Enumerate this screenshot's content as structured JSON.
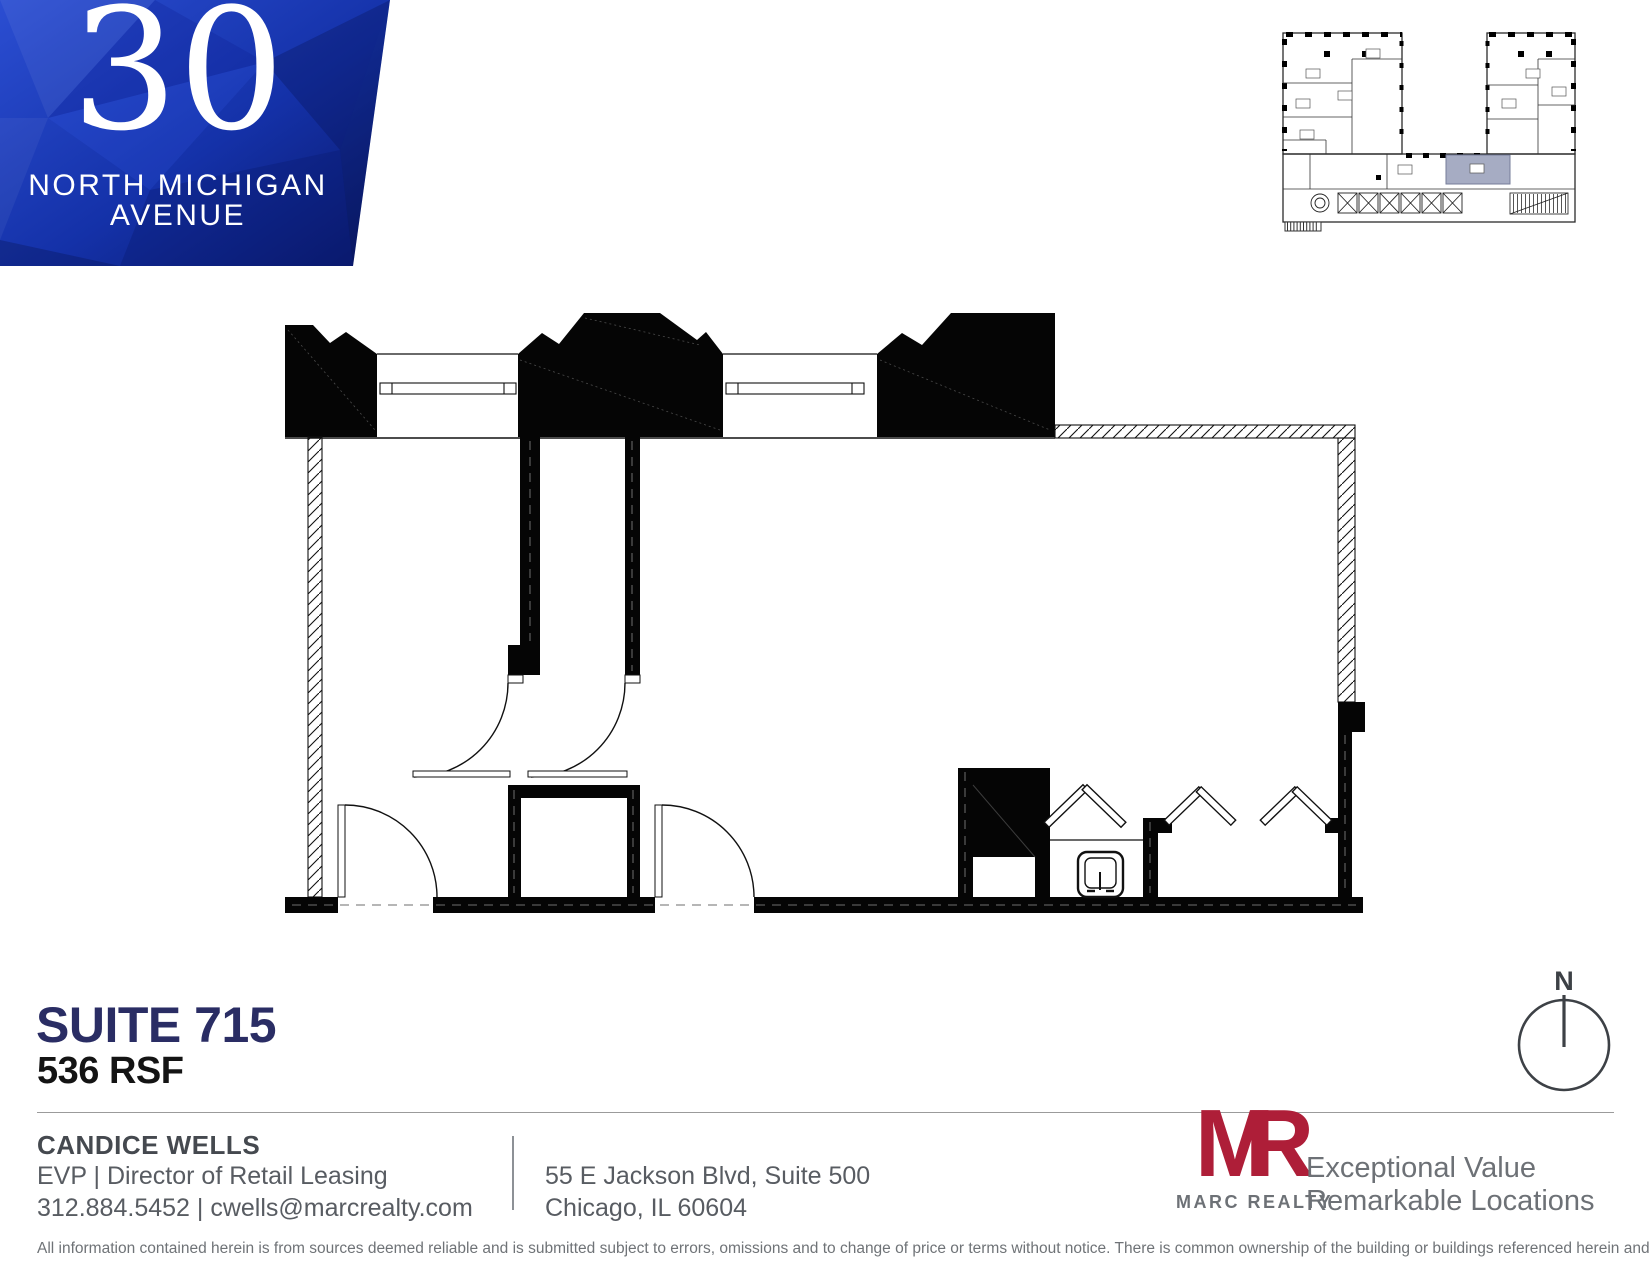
{
  "building": {
    "number": "30",
    "name_line1": "NORTH MICHIGAN",
    "name_line2": "AVENUE"
  },
  "suite": {
    "title": "SUITE 715",
    "area": "536 RSF"
  },
  "compass": {
    "label": "N"
  },
  "contact": {
    "name": "CANDICE WELLS",
    "title": "EVP | Director of Retail Leasing",
    "phone_email": "312.884.5452 | cwells@marcrealty.com"
  },
  "address": {
    "line1": "55 E Jackson Blvd, Suite 500",
    "line2": "Chicago, IL 60604"
  },
  "brand": {
    "logo_m": "M",
    "logo_r": "R",
    "name": "MARC REALTY",
    "tagline_line1": "Exceptional Value",
    "tagline_line2": "Remarkable Locations"
  },
  "disclaimer": "All information contained herein is from sources deemed reliable and is submitted subject to errors, omissions and to change of price or terms without notice. There is common ownership of the building or buildings referenced herein and Marc Realty LLC.TW",
  "colors": {
    "banner_blue_top": "#2b4ed2",
    "banner_blue_bottom": "#0a1766",
    "suite_title_navy": "#2a2d64",
    "brand_red": "#ae1e38",
    "key_plan_highlight": "#a6acc3",
    "footer_gray": "#6d7176"
  }
}
